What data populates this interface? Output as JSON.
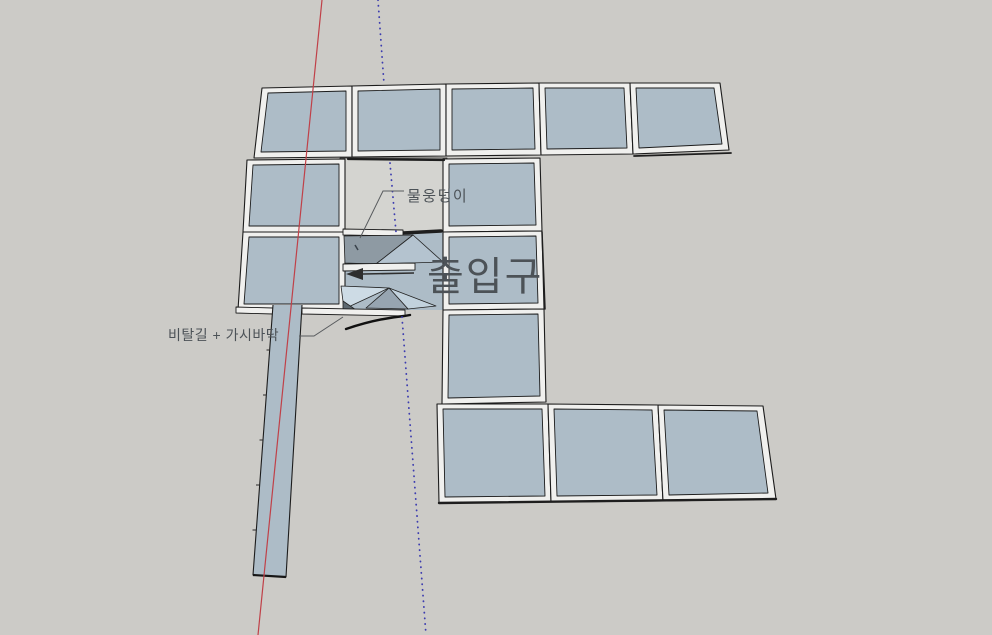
{
  "viewport": {
    "annotations": {
      "puddle_label": "물웅덩이",
      "entrance_label": "출입구",
      "slope_label": "비탈길 + 가시바닥"
    },
    "colors": {
      "background": "#cccbc7",
      "tile_face": "#adbcc7",
      "frame": "#f0f0ee",
      "recessed_floor": "#d4d4d0",
      "ramp_dark": "#8e9aa3",
      "ramp_lit": "#b4c3cf",
      "ramp_light": "#cddbe5",
      "ramp_mid": "#97a5b1",
      "ramp_pale": "#c2d2dd",
      "ramp_darkest": "#5d6870",
      "shadow": "#1e1e1e",
      "axis_red": "#c04048",
      "axis_blue": "#3c3caf",
      "leader": "#585b5e",
      "text": "#4c5257",
      "arrow": "#2e2e2e"
    }
  }
}
